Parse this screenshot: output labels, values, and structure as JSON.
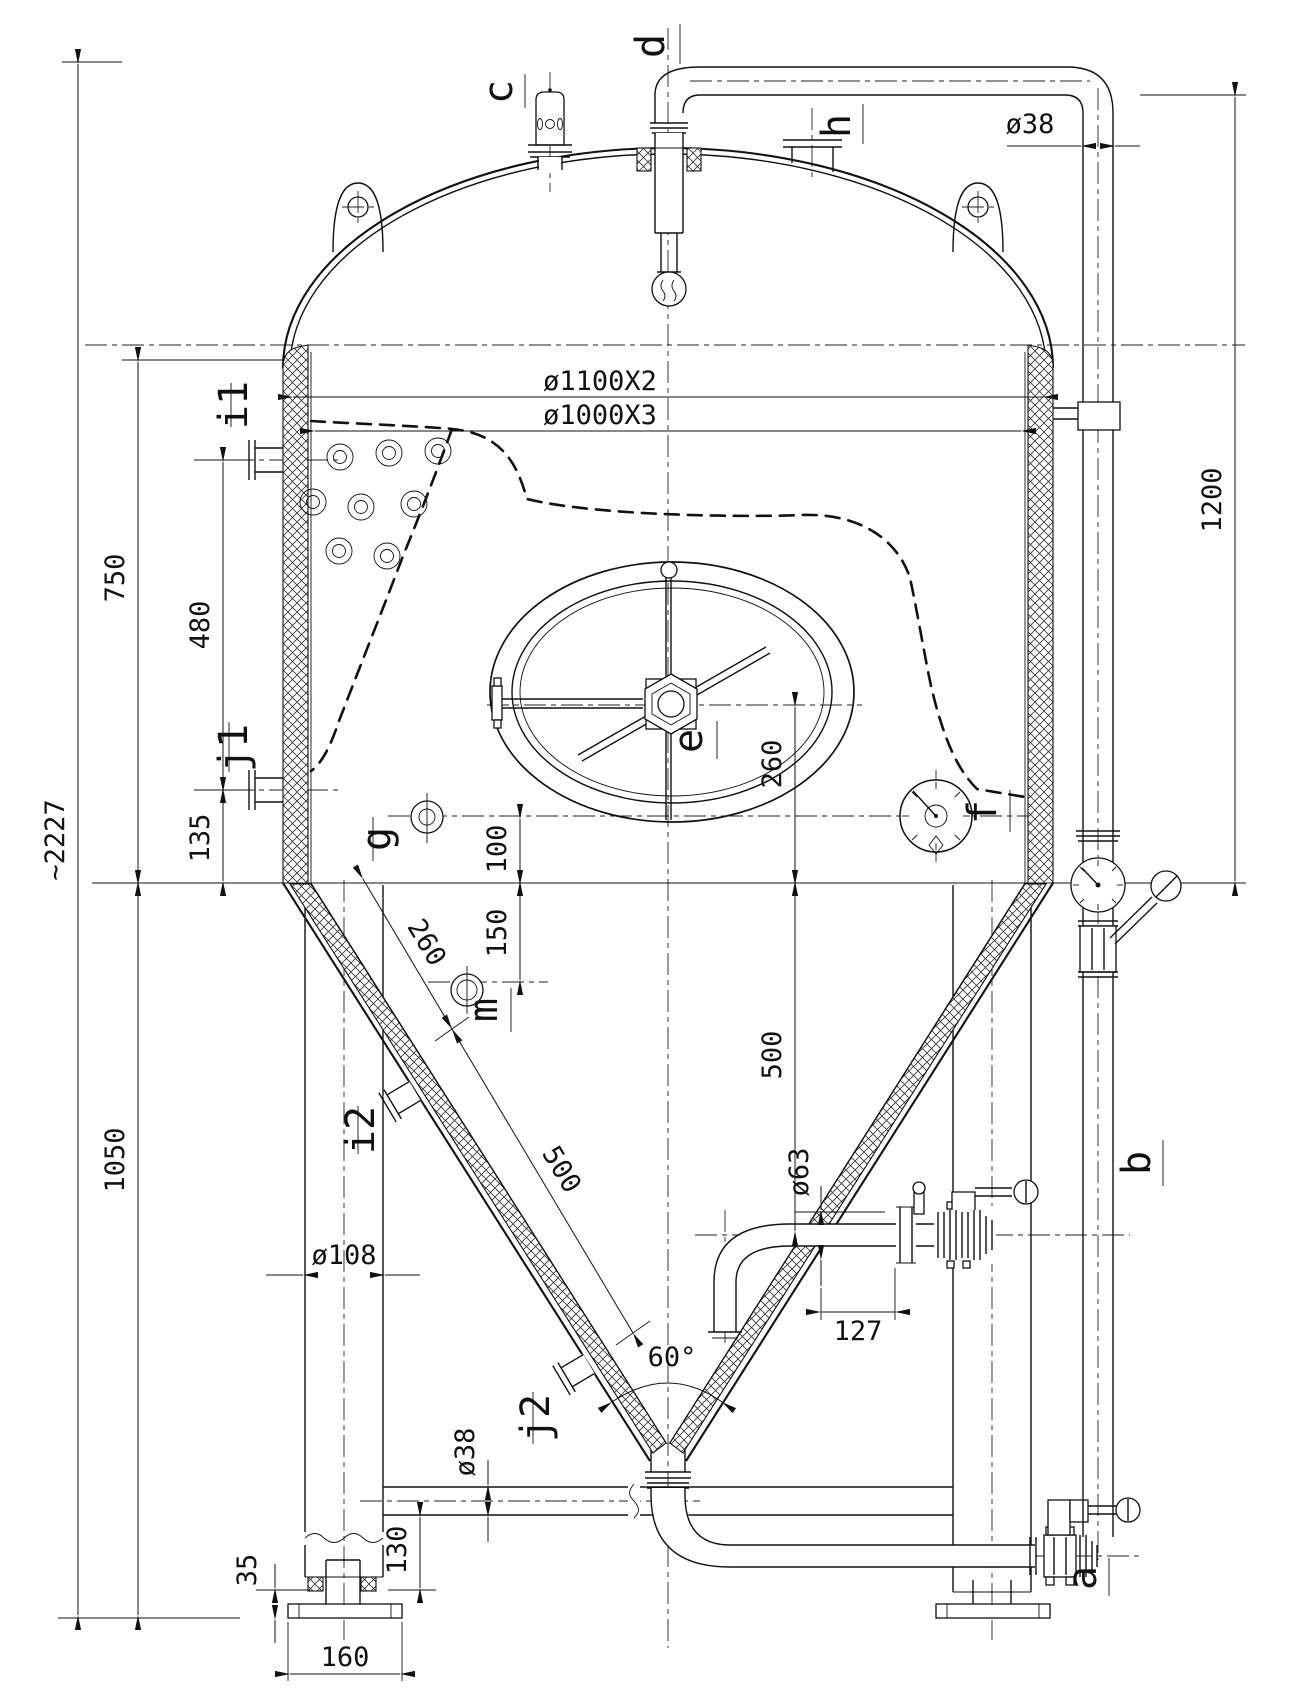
{
  "labels": {
    "a": "a",
    "b": "b",
    "c": "c",
    "d": "d",
    "e": "e",
    "f": "f",
    "g": "g",
    "h": "h",
    "i1": "i1",
    "i2": "i2",
    "j1": "j1",
    "j2": "j2",
    "m": "m"
  },
  "dims": {
    "overall_height": "~2227",
    "upper_shell": "750",
    "left_span": "480",
    "left_offset": "135",
    "lower_section": "1050",
    "shell_od": "ø1100X2",
    "shell_id": "ø1000X3",
    "downpipe_len": "1200",
    "downpipe_dia": "ø38",
    "manway_h": "260",
    "sample_h": "100",
    "port_h": "150",
    "cone_span_upper": "260",
    "cone_span_lower": "500",
    "racking_h": "500",
    "leg_dia": "ø108",
    "racking_dia": "ø63",
    "racking_x": "127",
    "cone_angle": "60°",
    "cross_dia": "ø38",
    "cross_h": "130",
    "foot_adj": "35",
    "foot_w": "160"
  }
}
